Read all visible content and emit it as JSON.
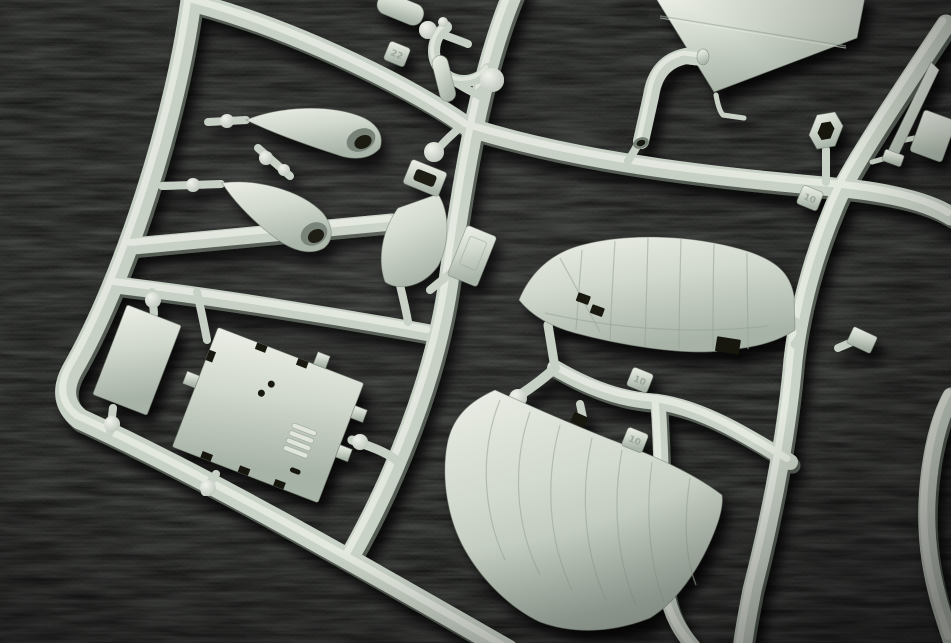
{
  "scene": {
    "type": "macro-photograph",
    "subject": "plastic model kit sprue (injection-moulded parts tree)",
    "background_material": "black woven fabric",
    "plastic_color_name": "light grey-green styrene",
    "colors": {
      "background": "#0a0b0a",
      "plastic_highlight": "#eef1e9",
      "plastic_mid": "#d3dacf",
      "plastic_deep": "#a9b4a8",
      "runner_base": "#c9d2c7",
      "runner_highlight": "#ebefe7",
      "runner_shadow": "#6f7a6f",
      "recess": "#121511",
      "mouth": "#768176",
      "tag_text": "#9aa698",
      "ball_highlight": "#f2f4ee",
      "ball_deep": "#b6c0b4"
    }
  },
  "sprue": {
    "tags": {
      "a": "22",
      "b": "10",
      "c": "10",
      "d": "10"
    },
    "parts": [
      {
        "name": "wing-half-upper",
        "description": "large curved wing half with engraved chordwise panel lines and locating slots"
      },
      {
        "name": "wing-half-lower",
        "description": "large curved wing half with raised rib lines and trailing-edge gate"
      },
      {
        "name": "triangular-panel",
        "description": "triangular panel part cropped by top edge of frame"
      },
      {
        "name": "curved-fairing-upper",
        "description": "pointed air-scoop fairing with open mouth"
      },
      {
        "name": "curved-fairing-lower",
        "description": "pointed air-scoop fairing with open mouth"
      },
      {
        "name": "shackle-u-part",
        "description": "U-shaped shackle with ball end"
      },
      {
        "name": "capsule-part",
        "description": "small capsule / bomb-shaped part"
      },
      {
        "name": "tank-with-slot-bracket",
        "description": "tapered tank body with rectangular slotted bracket and ball gate"
      },
      {
        "name": "elbow-pipe",
        "description": "L-shaped pipe with open bore"
      },
      {
        "name": "hex-ring",
        "description": "hexagonal ring (nut-shaped) part"
      },
      {
        "name": "pitot-blade",
        "description": "thin tapered blade / pitot part"
      },
      {
        "name": "rectangular-panel-small",
        "description": "small rectangular flat panel"
      },
      {
        "name": "louvered-access-panel",
        "description": "large rectangular panel with louvre vents, two holes and castellated edges"
      },
      {
        "name": "door-panel-small",
        "description": "small embossed door panel near centre runner"
      },
      {
        "name": "ball-gate-knobs",
        "description": "spherical sprue-gate knobs"
      }
    ],
    "runner_count_visible": 11
  }
}
